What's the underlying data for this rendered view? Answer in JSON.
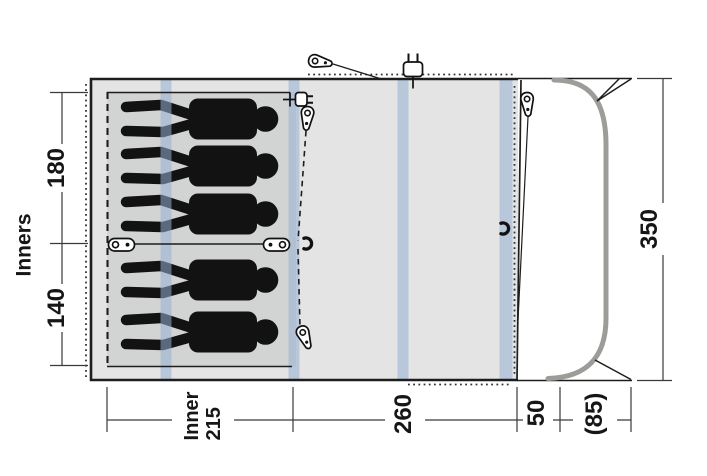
{
  "diagram_title": "tent floor plan",
  "dims": {
    "inners_title": "Inners",
    "inner_width_top": "180",
    "inner_width_bottom": "140",
    "inner_length_label": "Inner",
    "inner_length_value": "215",
    "living_length": "260",
    "front_section": "50",
    "porch_extension": "(85)",
    "total_width": "350"
  },
  "colors": {
    "floor": "#e3e4e3",
    "inner": "#d2d4d3",
    "stripe": "rgba(151,174,213,0.55)",
    "pole": "#9c9c98",
    "line": "#1d1d1d"
  },
  "icons": {
    "tent-peg": "teardrop-peg-shape",
    "power-plug": "two-prong-plug-shape",
    "toggle-clip": "oval-toggle-shape",
    "c-hook": "open-arc-hook-shape",
    "sleeping-person": "black-silhouette-lying"
  }
}
